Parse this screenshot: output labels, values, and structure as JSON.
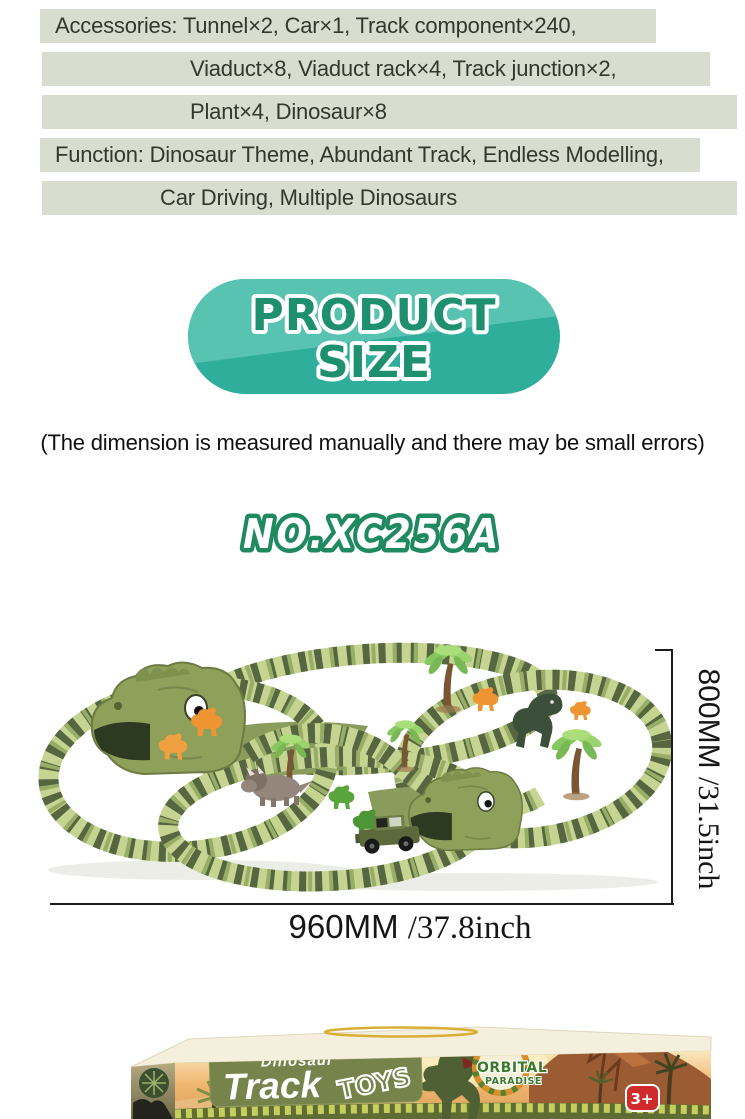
{
  "specs": {
    "lines": [
      "Accessories: Tunnel×2, Car×1, Track component×240,",
      "Viaduct×8, Viaduct rack×4, Track junction×2,",
      "Plant×4, Dinosaur×8",
      "Function: Dinosaur Theme, Abundant Track, Endless Modelling,",
      "Car Driving, Multiple Dinosaurs"
    ]
  },
  "size_badge": {
    "line1": "PRODUCT",
    "line2": "SIZE"
  },
  "disclaimer": "(The dimension is measured manually and there may be small errors)",
  "model_number": "NO.XC256A",
  "dimensions": {
    "width_mm": "960MM",
    "width_inch": "/37.8inch",
    "height_mm": "800MM",
    "height_inch": "/31.5inch"
  },
  "box": {
    "brand_top": "Dinosaur",
    "brand_main": "Track",
    "brand_suffix": "TOYS",
    "logo_line1": "ORBITAL",
    "logo_line2": "PARADISE",
    "age_badge": "3+"
  },
  "colors": {
    "spec_bar_bg": "#d9ddcf",
    "spec_text": "#33372e",
    "pill_teal": "#2fae9c",
    "pill_teal_light": "#58c3b1",
    "pill_text_green": "#1e9070",
    "model_outline_green": "#1f8a60",
    "dimension_line": "#1c1c1c",
    "track_light": "#c6d492",
    "track_dark": "#556640",
    "box_panel_olive": "#76834b",
    "age_badge_red": "#cf2b2a"
  }
}
